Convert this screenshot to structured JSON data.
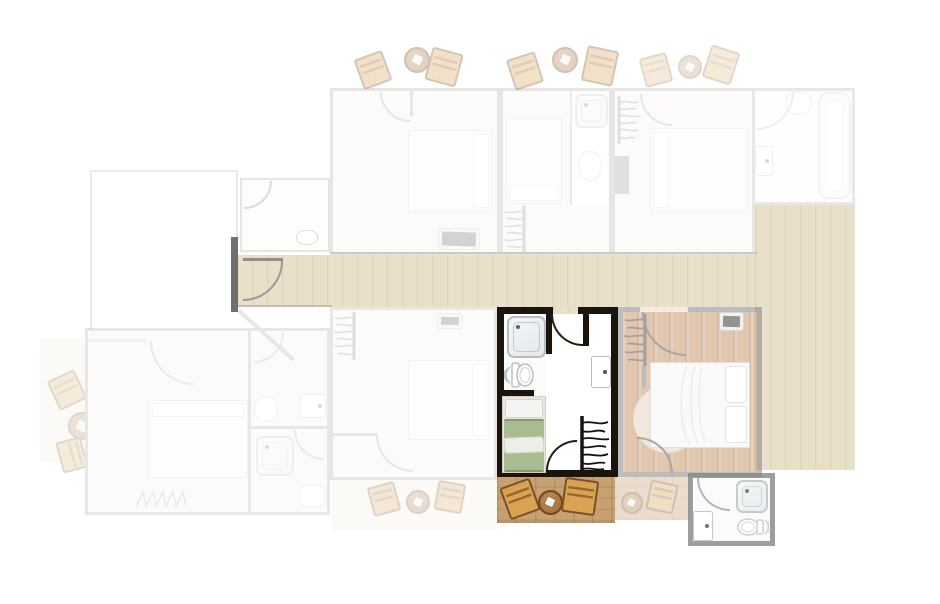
{
  "plan": {
    "kind": "apartment-floor-plan",
    "colors": {
      "background": "#ffffff",
      "wall_highlight": "#1b140d",
      "wall_standard": "#8f8f8f",
      "floor_wood": "#7e5835",
      "floor_wood_neighbor": "#c89a6b",
      "floor_corridor": "#eadfc9",
      "deck": "#c7a173",
      "bed_green": "#a9bc90",
      "furniture_orange": "#d9a255",
      "furniture_outline": "#7a5220",
      "bathroom_floor": "#fbfbfb",
      "fixture_outline": "#b7bdc0",
      "rug": "#e6d4bf"
    },
    "highlighted_room": {
      "name": "studio-room",
      "features": [
        "entry-door",
        "bathroom",
        "shower",
        "toilet",
        "washbasin",
        "single-bed",
        "wardrobe-rail",
        "terrace-door",
        "terrace"
      ]
    },
    "rooms": [
      {
        "name": "studio-room",
        "state": "highlighted"
      },
      {
        "name": "double-bedroom-east",
        "state": "semi-visible"
      },
      {
        "name": "bathroom-southeast",
        "state": "semi-visible"
      },
      {
        "name": "corridor",
        "state": "visible"
      },
      {
        "name": "terrace-east",
        "state": "visible"
      },
      {
        "name": "terrace-south",
        "state": "highlighted"
      },
      {
        "name": "bedroom-middle-south",
        "state": "faded"
      },
      {
        "name": "suite-southwest",
        "state": "faded"
      },
      {
        "name": "bedroom-north-west",
        "state": "faded"
      },
      {
        "name": "bedroom-north-middle",
        "state": "faded"
      },
      {
        "name": "bedroom-north-east",
        "state": "faded"
      },
      {
        "name": "bathroom-northeast",
        "state": "faded"
      }
    ]
  }
}
